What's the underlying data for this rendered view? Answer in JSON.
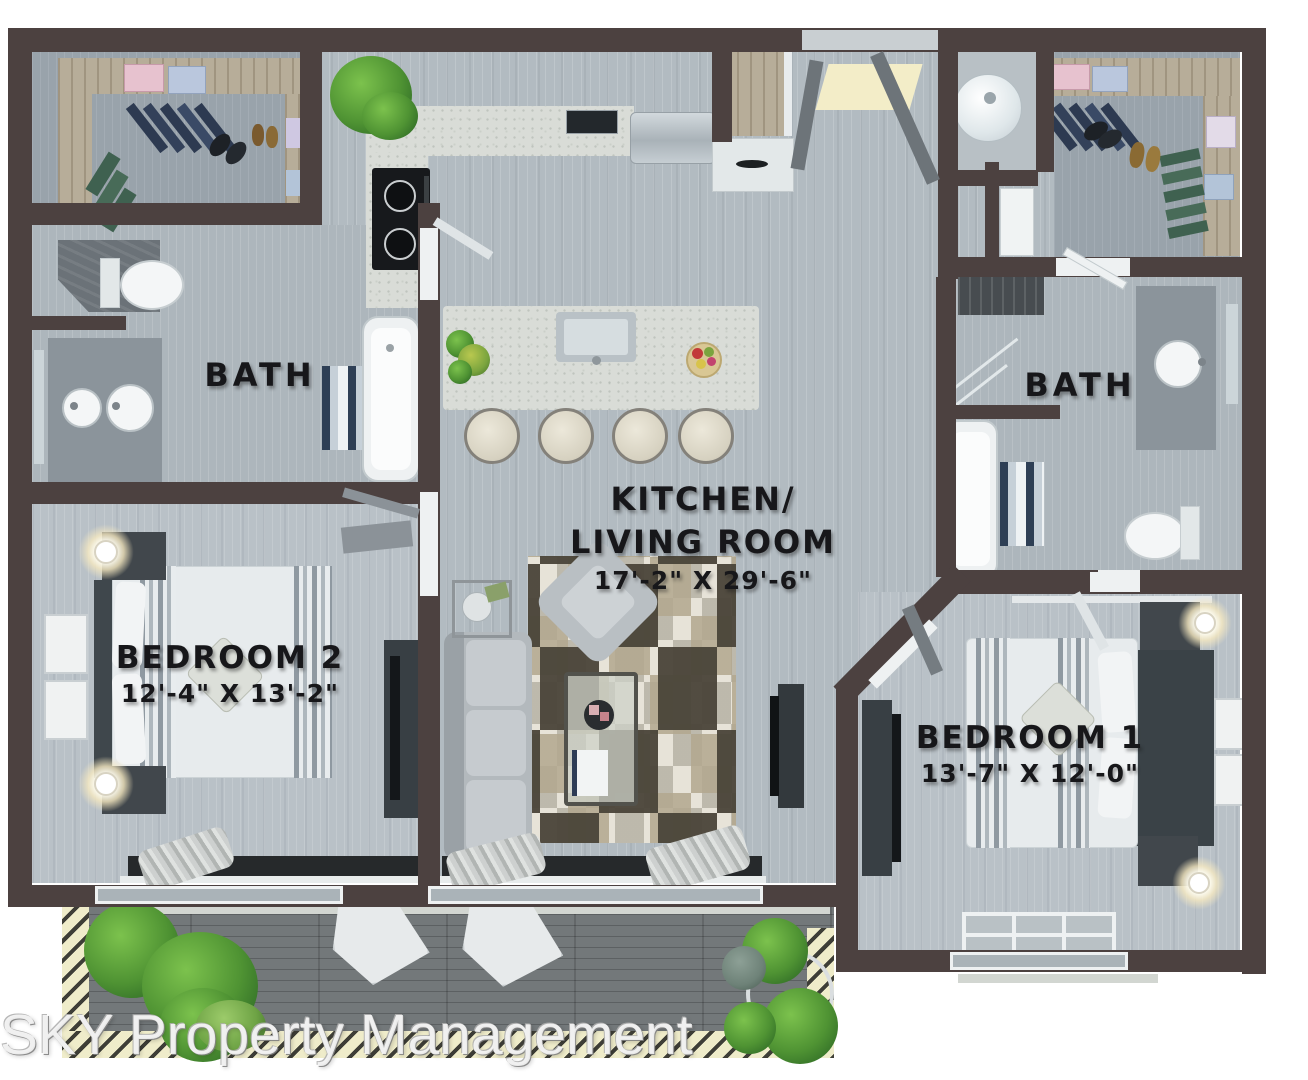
{
  "floorplan": {
    "labels": {
      "bath_left": "BATH",
      "bath_right": "BATH",
      "kitchen_line1": "KITCHEN/",
      "kitchen_line2": "LIVING ROOM",
      "kitchen_dims": "17'-2\" X 29'-6\"",
      "bedroom2_name": "BEDROOM 2",
      "bedroom2_dims": "12'-4\" X 13'-2\"",
      "bedroom1_name": "BEDROOM 1",
      "bedroom1_dims": "13'-7\" X 12'-0\""
    },
    "watermark": "SKY Property Management",
    "colors": {
      "wall": "#4c4140",
      "floor_main": "#b2bbc1",
      "floor_deck": "#73787a",
      "deck_border_stripe": "#efecca",
      "counter_marble": "#d9dcd7",
      "plant_green": "#4f9333",
      "label_ink": "#17171a",
      "fixture_white": "#eef1f2"
    }
  }
}
